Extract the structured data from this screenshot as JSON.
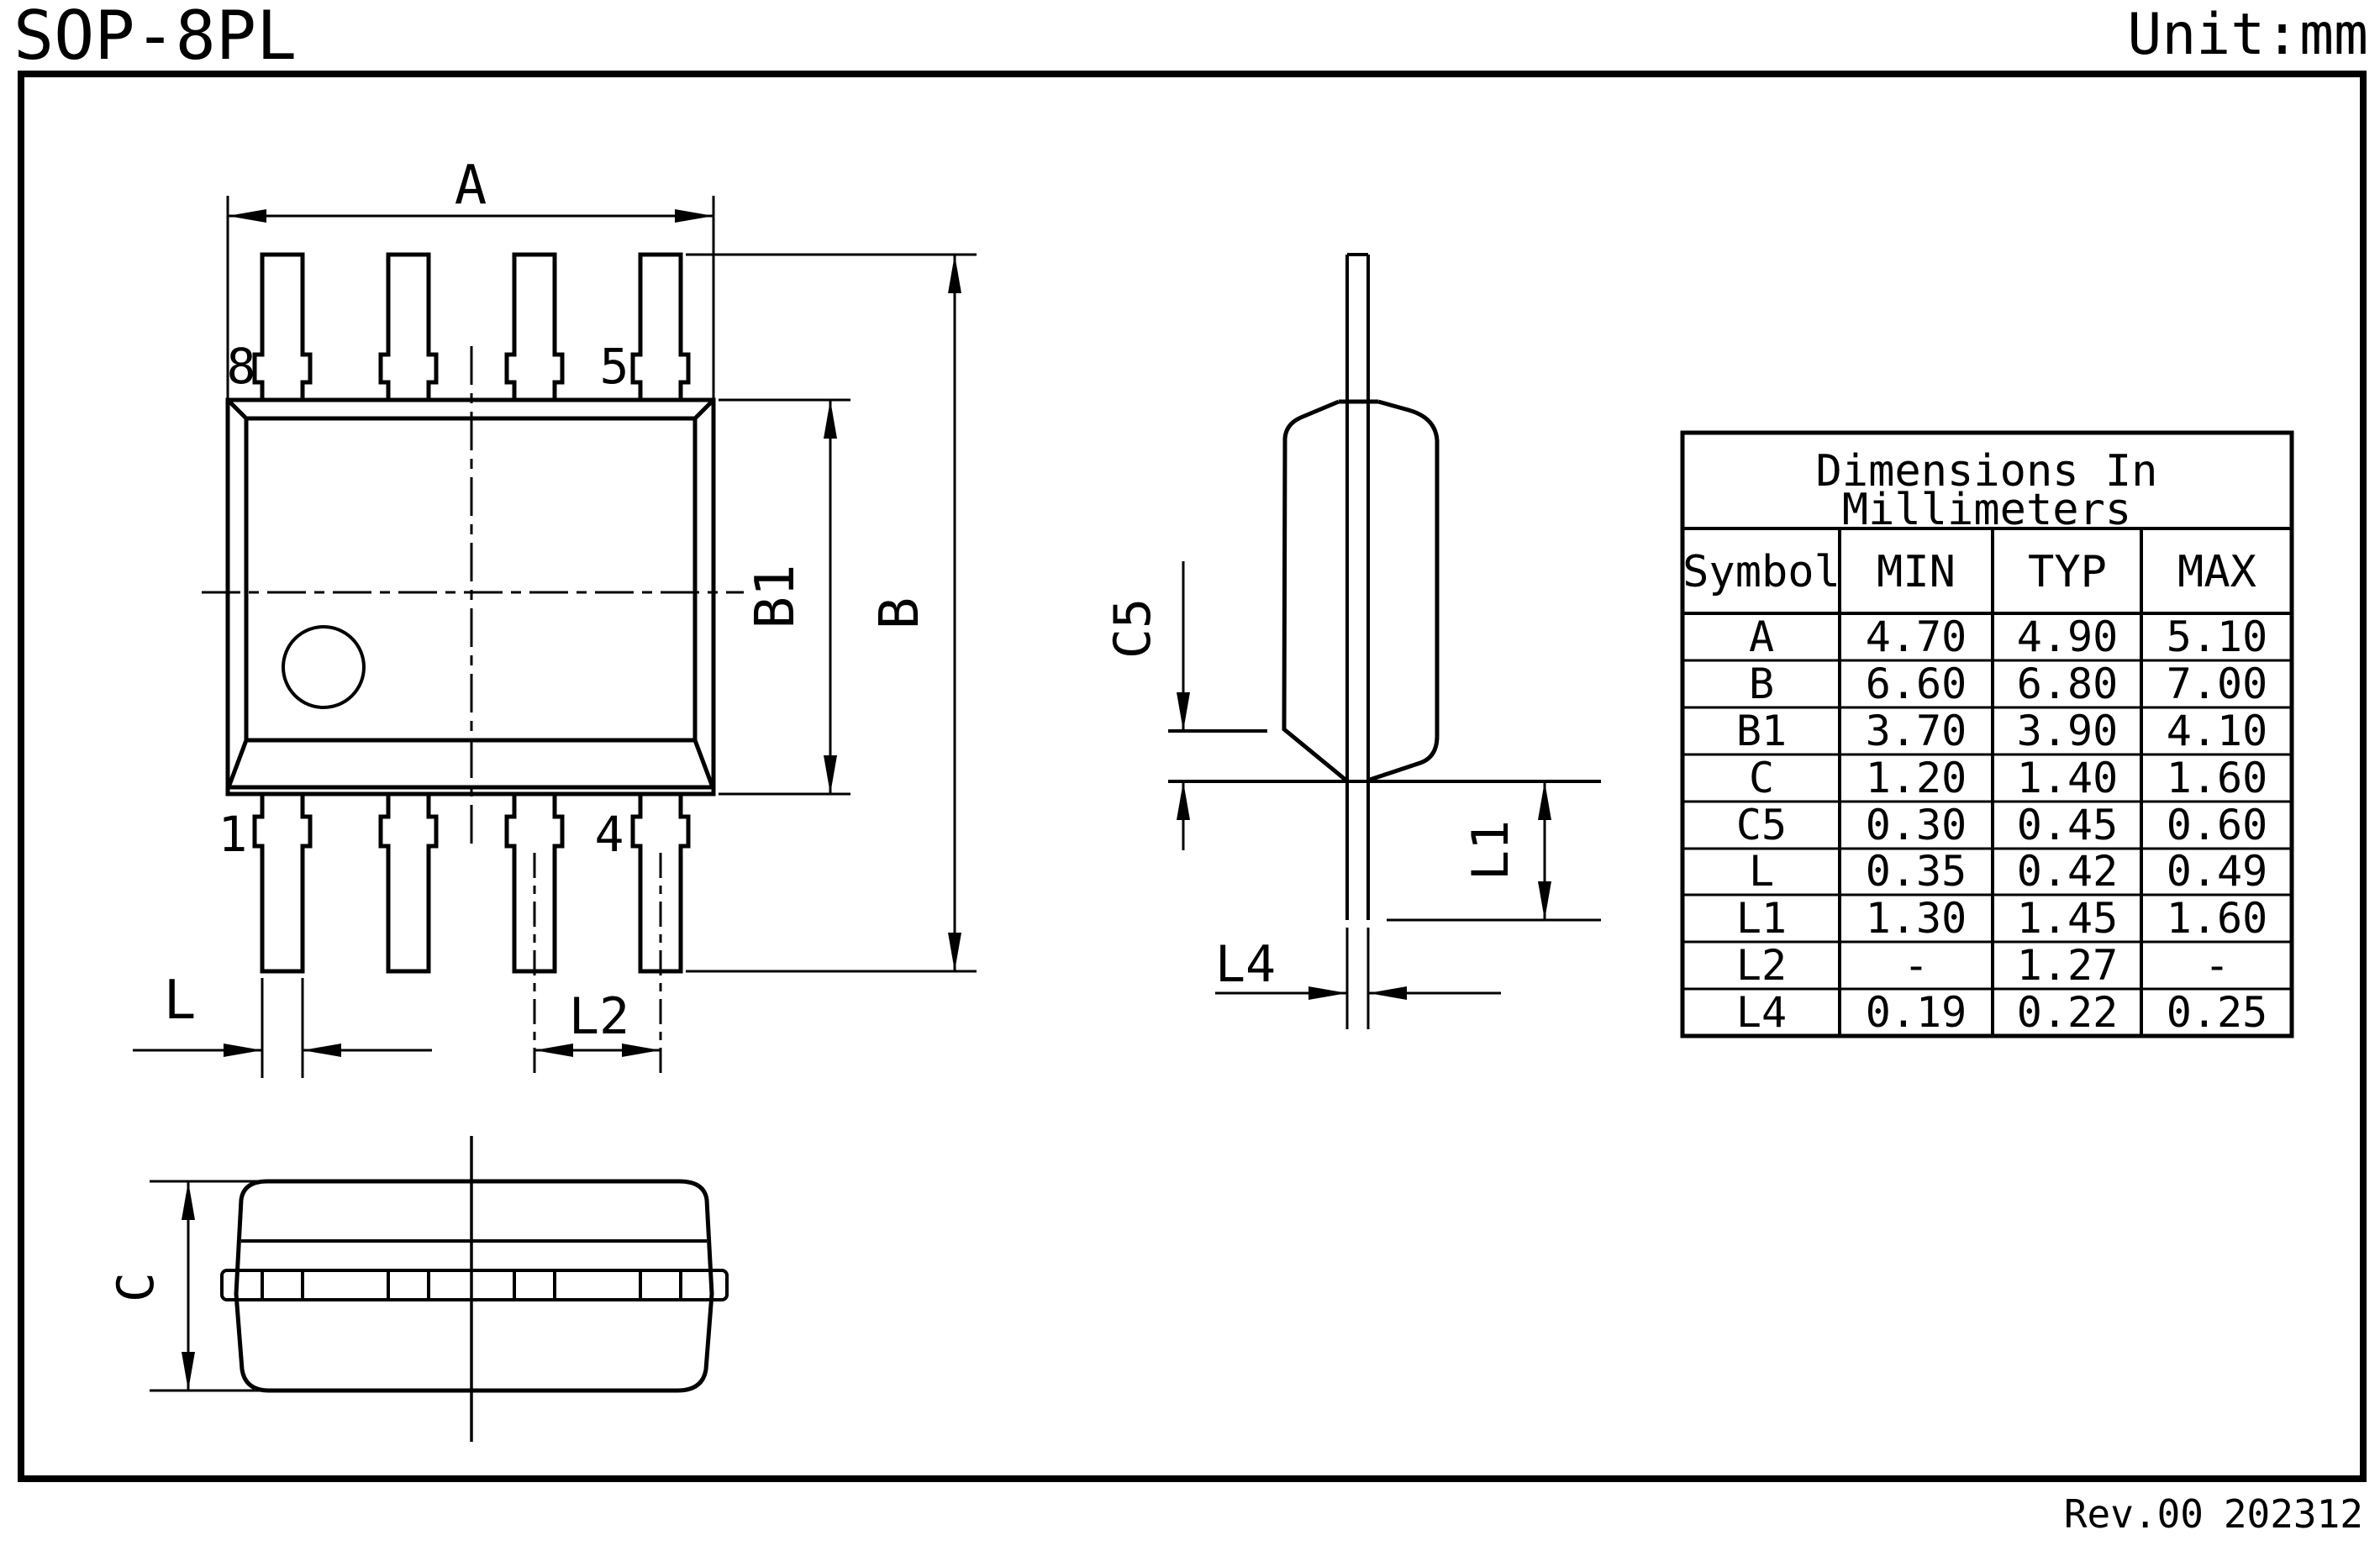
{
  "page": {
    "title": "SOP-8PL",
    "unit": "Unit:mm",
    "revision": "Rev.00",
    "date_code": "202312"
  },
  "top_view": {
    "dim_a": "A",
    "dim_b": "B",
    "dim_b1": "B1",
    "dim_l": "L",
    "dim_l2": "L2",
    "pin_top_left": "8",
    "pin_top_right": "5",
    "pin_bottom_left": "1",
    "pin_bottom_right": "4"
  },
  "side_view": {
    "dim_c5": "C5",
    "dim_l1": "L1",
    "dim_l4": "L4"
  },
  "front_view": {
    "dim_c": "C"
  },
  "table": {
    "title_line1": "Dimensions In",
    "title_line2": "Millimeters",
    "columns": [
      "Symbol",
      "MIN",
      "TYP",
      "MAX"
    ],
    "rows": [
      {
        "symbol": "A",
        "min": "4.70",
        "typ": "4.90",
        "max": "5.10"
      },
      {
        "symbol": "B",
        "min": "6.60",
        "typ": "6.80",
        "max": "7.00"
      },
      {
        "symbol": "B1",
        "min": "3.70",
        "typ": "3.90",
        "max": "4.10"
      },
      {
        "symbol": "C",
        "min": "1.20",
        "typ": "1.40",
        "max": "1.60"
      },
      {
        "symbol": "C5",
        "min": "0.30",
        "typ": "0.45",
        "max": "0.60"
      },
      {
        "symbol": "L",
        "min": "0.35",
        "typ": "0.42",
        "max": "0.49"
      },
      {
        "symbol": "L1",
        "min": "1.30",
        "typ": "1.45",
        "max": "1.60"
      },
      {
        "symbol": "L2",
        "min": "-",
        "typ": "1.27",
        "max": "-"
      },
      {
        "symbol": "L4",
        "min": "0.19",
        "typ": "0.22",
        "max": "0.25"
      }
    ]
  }
}
